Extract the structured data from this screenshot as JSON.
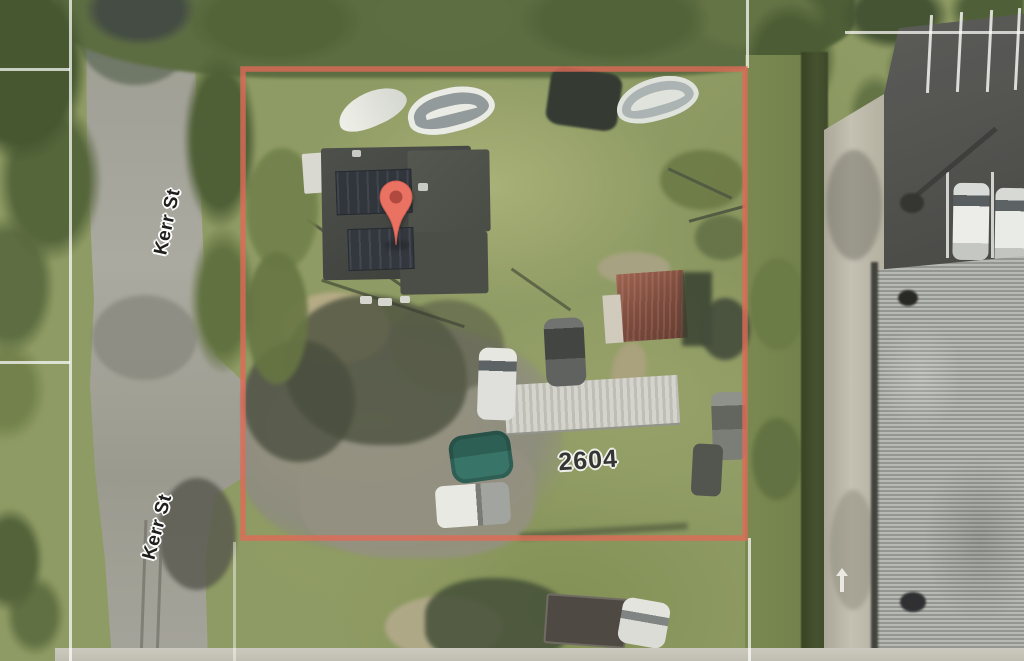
{
  "map": {
    "street_labels": [
      {
        "text": "Kerr St"
      },
      {
        "text": "Kerr St"
      }
    ],
    "property": {
      "house_number": "2604",
      "boundary_color": "#DE6450"
    },
    "marker": {
      "fill": "#E96C5C",
      "stroke": "#CE574A",
      "dot": "#AD4137"
    },
    "colors": {
      "grass": "#8A975E",
      "road": "#A2A198",
      "asphalt": "#4E4E4C",
      "large_roof": "#AFB1AD",
      "trailer_roof": "#E2E2DC",
      "house_roof": "#3B3E3A",
      "parcel_line": "#FFFFFF"
    }
  }
}
